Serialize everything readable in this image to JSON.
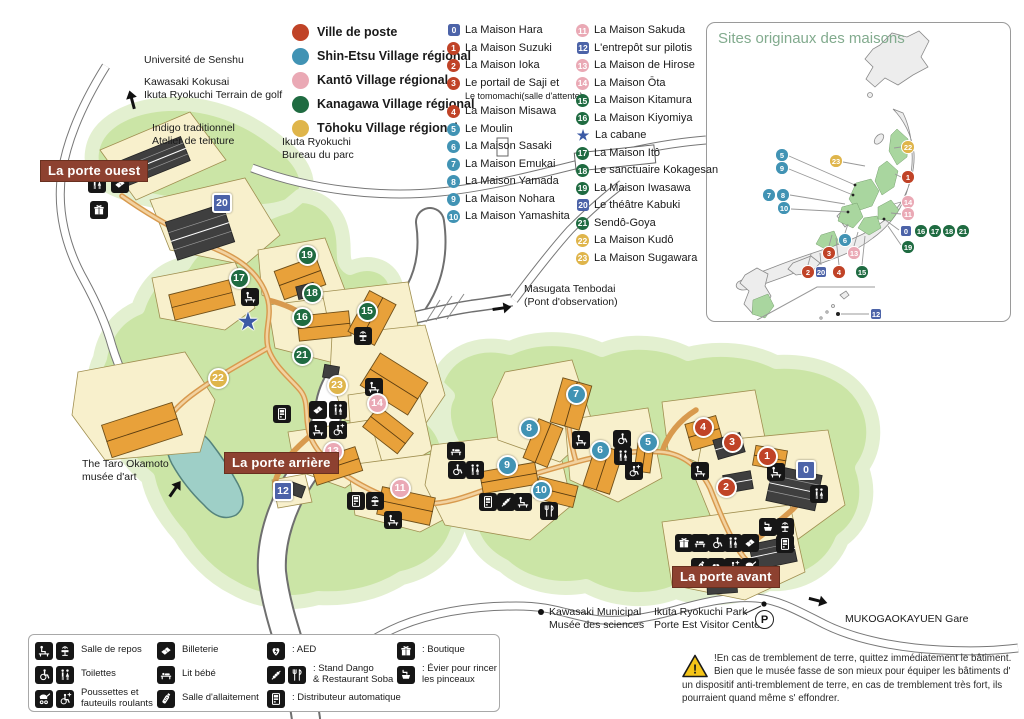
{
  "colors": {
    "red": "#c04327",
    "blue": "#4193b4",
    "pink": "#eaa9b5",
    "green": "#1f6b41",
    "yellow": "#dfb54b",
    "sqblue": "#4c63a8",
    "star": "#3b5aa5",
    "gate": "#8d4130",
    "title_green": "#82ab8e"
  },
  "villages": [
    {
      "label": "Ville de poste",
      "color": "red"
    },
    {
      "label": "Shin-Etsu Village régional",
      "color": "blue"
    },
    {
      "label": "Kantō Village régional",
      "color": "pink"
    },
    {
      "label": "Kanagawa Village régional",
      "color": "green"
    },
    {
      "label": "Tōhoku Village régional",
      "color": "yellow"
    }
  ],
  "houses": {
    "col1": [
      {
        "n": "0",
        "shape": "sq",
        "color": "sqblue",
        "label": "La Maison Hara"
      },
      {
        "n": "1",
        "shape": "c",
        "color": "red",
        "label": "La Maison Suzuki"
      },
      {
        "n": "2",
        "shape": "c",
        "color": "red",
        "label": "La Maison Ioka"
      },
      {
        "n": "3",
        "shape": "c",
        "color": "red",
        "label": "Le portail de Saji et",
        "sub": "Le tomomachi(salle d'attente)"
      },
      {
        "n": "4",
        "shape": "c",
        "color": "red",
        "label": "La Maison Misawa"
      },
      {
        "n": "5",
        "shape": "c",
        "color": "blue",
        "label": "Le Moulin"
      },
      {
        "n": "6",
        "shape": "c",
        "color": "blue",
        "label": "La Maison Sasaki"
      },
      {
        "n": "7",
        "shape": "c",
        "color": "blue",
        "label": "La Maison Emukai"
      },
      {
        "n": "8",
        "shape": "c",
        "color": "blue",
        "label": "La Maison Yamada"
      },
      {
        "n": "9",
        "shape": "c",
        "color": "blue",
        "label": "La Maison Nohara"
      },
      {
        "n": "10",
        "shape": "c",
        "color": "blue",
        "label": "La Maison Yamashita"
      }
    ],
    "col2": [
      {
        "n": "11",
        "shape": "c",
        "color": "pink",
        "label": "La Maison Sakuda"
      },
      {
        "n": "12",
        "shape": "sq",
        "color": "sqblue",
        "label": "L'entrepôt sur pilotis"
      },
      {
        "n": "13",
        "shape": "c",
        "color": "pink",
        "label": "La Maison de Hirose"
      },
      {
        "n": "14",
        "shape": "c",
        "color": "pink",
        "label": "La Maison Ōta"
      },
      {
        "n": "15",
        "shape": "c",
        "color": "green",
        "label": "La Maison Kitamura"
      },
      {
        "n": "16",
        "shape": "c",
        "color": "green",
        "label": "La Maison Kiyomiya"
      },
      {
        "n": "★",
        "shape": "st",
        "color": "star",
        "label": "La cabane"
      },
      {
        "n": "17",
        "shape": "c",
        "color": "green",
        "label": "La Maison Itô"
      },
      {
        "n": "18",
        "shape": "c",
        "color": "green",
        "label": "Le sanctuaire Kokagesan"
      },
      {
        "n": "19",
        "shape": "c",
        "color": "green",
        "label": "La Maison Iwasawa"
      },
      {
        "n": "20",
        "shape": "sq",
        "color": "sqblue",
        "label": "Le théâtre Kabuki"
      },
      {
        "n": "21",
        "shape": "c",
        "color": "green",
        "label": "Sendô-Goya"
      },
      {
        "n": "22",
        "shape": "c",
        "color": "yellow",
        "label": "La Maison Kudô"
      },
      {
        "n": "23",
        "shape": "c",
        "color": "yellow",
        "label": "La Maison Sugawara"
      }
    ]
  },
  "inset": {
    "title": "Sites originaux des maisons",
    "markers": [
      {
        "n": "5",
        "shape": "c",
        "color": "blue",
        "x": 75,
        "y": 132
      },
      {
        "n": "9",
        "shape": "c",
        "color": "blue",
        "x": 75,
        "y": 145
      },
      {
        "n": "7",
        "shape": "c",
        "color": "blue",
        "x": 62,
        "y": 172
      },
      {
        "n": "8",
        "shape": "c",
        "color": "blue",
        "x": 76,
        "y": 172
      },
      {
        "n": "10",
        "shape": "c",
        "color": "blue",
        "x": 77,
        "y": 185
      },
      {
        "n": "23",
        "shape": "c",
        "color": "yellow",
        "x": 129,
        "y": 138
      },
      {
        "n": "22",
        "shape": "c",
        "color": "yellow",
        "x": 201,
        "y": 124
      },
      {
        "n": "1",
        "shape": "c",
        "color": "red",
        "x": 201,
        "y": 154
      },
      {
        "n": "14",
        "shape": "c",
        "color": "pink",
        "x": 201,
        "y": 179
      },
      {
        "n": "11",
        "shape": "c",
        "color": "pink",
        "x": 201,
        "y": 191
      },
      {
        "n": "0",
        "shape": "sq",
        "color": "sqblue",
        "x": 199,
        "y": 208
      },
      {
        "n": "16",
        "shape": "c",
        "color": "green",
        "x": 214,
        "y": 208
      },
      {
        "n": "17",
        "shape": "c",
        "color": "green",
        "x": 228,
        "y": 208
      },
      {
        "n": "18",
        "shape": "c",
        "color": "green",
        "x": 242,
        "y": 208
      },
      {
        "n": "21",
        "shape": "c",
        "color": "green",
        "x": 256,
        "y": 208
      },
      {
        "n": "19",
        "shape": "c",
        "color": "green",
        "x": 201,
        "y": 224
      },
      {
        "n": "6",
        "shape": "c",
        "color": "blue",
        "x": 138,
        "y": 217
      },
      {
        "n": "3",
        "shape": "c",
        "color": "red",
        "x": 122,
        "y": 230
      },
      {
        "n": "13",
        "shape": "c",
        "color": "pink",
        "x": 147,
        "y": 230
      },
      {
        "n": "2",
        "shape": "c",
        "color": "red",
        "x": 101,
        "y": 249
      },
      {
        "n": "20",
        "shape": "sq",
        "color": "sqblue",
        "x": 114,
        "y": 249
      },
      {
        "n": "4",
        "shape": "c",
        "color": "red",
        "x": 132,
        "y": 249
      },
      {
        "n": "15",
        "shape": "c",
        "color": "green",
        "x": 155,
        "y": 249
      },
      {
        "n": "12",
        "shape": "sq",
        "color": "sqblue",
        "x": 169,
        "y": 291
      }
    ]
  },
  "map": {
    "parking_label": "P",
    "gates": [
      {
        "t": "La porte ouest",
        "x": 40,
        "y": 160
      },
      {
        "t": "La porte arrière",
        "x": 224,
        "y": 452
      },
      {
        "t": "La porte avant",
        "x": 672,
        "y": 566
      }
    ],
    "labels": [
      {
        "t": "Université de Senshu",
        "x": 144,
        "y": 54
      },
      {
        "t": "Kawasaki Kokusai\nIkuta Ryokuchi Terrain de golf",
        "x": 144,
        "y": 76
      },
      {
        "t": "Indigo traditionnel\nAtelier de teinture",
        "x": 152,
        "y": 122
      },
      {
        "t": "Ikuta Ryokuchi\nBureau du parc",
        "x": 282,
        "y": 136
      },
      {
        "t": "Masugata Tenbodai\n(Pont d'observation)",
        "x": 524,
        "y": 283
      },
      {
        "t": "The Taro Okamoto\nmusée d'art",
        "x": 82,
        "y": 458
      },
      {
        "t": "Kawasaki Municipal\nMusée des sciences",
        "x": 549,
        "y": 606
      },
      {
        "t": "Ikuta Ryokuchi Park\nPorte Est Visitor Center",
        "x": 654,
        "y": 606
      },
      {
        "t": "MUKOGAOKAYUEN Gare",
        "x": 845,
        "y": 613
      }
    ],
    "markers": [
      {
        "n": "0",
        "shape": "sq",
        "color": "sqblue",
        "x": 806,
        "y": 470
      },
      {
        "n": "1",
        "shape": "c",
        "color": "red",
        "x": 767,
        "y": 456
      },
      {
        "n": "2",
        "shape": "c",
        "color": "red",
        "x": 726,
        "y": 487
      },
      {
        "n": "3",
        "shape": "c",
        "color": "red",
        "x": 732,
        "y": 442
      },
      {
        "n": "4",
        "shape": "c",
        "color": "red",
        "x": 703,
        "y": 427
      },
      {
        "n": "5",
        "shape": "c",
        "color": "blue",
        "x": 648,
        "y": 442
      },
      {
        "n": "6",
        "shape": "c",
        "color": "blue",
        "x": 600,
        "y": 450
      },
      {
        "n": "7",
        "shape": "c",
        "color": "blue",
        "x": 576,
        "y": 394
      },
      {
        "n": "8",
        "shape": "c",
        "color": "blue",
        "x": 529,
        "y": 428
      },
      {
        "n": "9",
        "shape": "c",
        "color": "blue",
        "x": 507,
        "y": 465
      },
      {
        "n": "10",
        "shape": "c",
        "color": "blue",
        "x": 541,
        "y": 490
      },
      {
        "n": "11",
        "shape": "c",
        "color": "pink",
        "x": 400,
        "y": 488
      },
      {
        "n": "12",
        "shape": "sq",
        "color": "sqblue",
        "x": 283,
        "y": 491
      },
      {
        "n": "13",
        "shape": "c",
        "color": "pink",
        "x": 333,
        "y": 451
      },
      {
        "n": "14",
        "shape": "c",
        "color": "pink",
        "x": 377,
        "y": 403
      },
      {
        "n": "15",
        "shape": "c",
        "color": "green",
        "x": 367,
        "y": 311
      },
      {
        "n": "16",
        "shape": "c",
        "color": "green",
        "x": 302,
        "y": 317
      },
      {
        "n": "17",
        "shape": "c",
        "color": "green",
        "x": 239,
        "y": 278
      },
      {
        "n": "18",
        "shape": "c",
        "color": "green",
        "x": 312,
        "y": 293
      },
      {
        "n": "19",
        "shape": "c",
        "color": "green",
        "x": 307,
        "y": 255
      },
      {
        "n": "20",
        "shape": "sq",
        "color": "sqblue",
        "x": 222,
        "y": 203
      },
      {
        "n": "21",
        "shape": "c",
        "color": "green",
        "x": 302,
        "y": 355
      },
      {
        "n": "22",
        "shape": "c",
        "color": "yellow",
        "x": 218,
        "y": 378
      },
      {
        "n": "23",
        "shape": "c",
        "color": "yellow",
        "x": 337,
        "y": 385
      },
      {
        "n": "★",
        "shape": "st",
        "color": "star",
        "x": 248,
        "y": 322
      }
    ],
    "icons": [
      {
        "i": "toilets",
        "x": 97,
        "y": 184
      },
      {
        "i": "ticket",
        "x": 120,
        "y": 184
      },
      {
        "i": "boutique",
        "x": 99,
        "y": 210
      },
      {
        "i": "rest",
        "x": 250,
        "y": 297
      },
      {
        "i": "fountain",
        "x": 363,
        "y": 336
      },
      {
        "i": "rest",
        "x": 374,
        "y": 387
      },
      {
        "i": "vending",
        "x": 282,
        "y": 414
      },
      {
        "i": "ticket",
        "x": 318,
        "y": 410
      },
      {
        "i": "toilets",
        "x": 338,
        "y": 410
      },
      {
        "i": "rest",
        "x": 318,
        "y": 430
      },
      {
        "i": "wheelchair-star",
        "x": 338,
        "y": 430
      },
      {
        "i": "rest",
        "x": 320,
        "y": 461
      },
      {
        "i": "vending",
        "x": 356,
        "y": 501
      },
      {
        "i": "fountain",
        "x": 375,
        "y": 501
      },
      {
        "i": "rest",
        "x": 393,
        "y": 520
      },
      {
        "i": "baby",
        "x": 456,
        "y": 451
      },
      {
        "i": "wheelchair",
        "x": 457,
        "y": 470
      },
      {
        "i": "toilets",
        "x": 475,
        "y": 470
      },
      {
        "i": "vending",
        "x": 488,
        "y": 502
      },
      {
        "i": "dango",
        "x": 506,
        "y": 502
      },
      {
        "i": "rest",
        "x": 523,
        "y": 502
      },
      {
        "i": "restaurant",
        "x": 549,
        "y": 511
      },
      {
        "i": "rest",
        "x": 581,
        "y": 440
      },
      {
        "i": "wheelchair",
        "x": 622,
        "y": 439
      },
      {
        "i": "toilets",
        "x": 623,
        "y": 456
      },
      {
        "i": "wheelchair-star",
        "x": 634,
        "y": 471
      },
      {
        "i": "rest",
        "x": 700,
        "y": 471
      },
      {
        "i": "rest",
        "x": 776,
        "y": 472
      },
      {
        "i": "toilets",
        "x": 819,
        "y": 494
      },
      {
        "i": "boutique",
        "x": 684,
        "y": 543
      },
      {
        "i": "baby",
        "x": 700,
        "y": 543
      },
      {
        "i": "wheelchair",
        "x": 717,
        "y": 543
      },
      {
        "i": "toilets",
        "x": 733,
        "y": 543
      },
      {
        "i": "ticket",
        "x": 750,
        "y": 543
      },
      {
        "i": "bottle",
        "x": 700,
        "y": 567
      },
      {
        "i": "aed",
        "x": 716,
        "y": 567
      },
      {
        "i": "wheelchair-star",
        "x": 733,
        "y": 567
      },
      {
        "i": "stroller",
        "x": 750,
        "y": 567
      },
      {
        "i": "sink",
        "x": 768,
        "y": 527
      },
      {
        "i": "fountain",
        "x": 785,
        "y": 527
      },
      {
        "i": "vending",
        "x": 785,
        "y": 544
      }
    ]
  },
  "facilities": {
    "columns": [
      [
        {
          "icons": [
            "rest",
            "fountain"
          ],
          "label": "Salle de repos"
        },
        {
          "icons": [
            "wheelchair",
            "toilets"
          ],
          "label": "Toilettes"
        },
        {
          "icons": [
            "stroller",
            "wheelchair-star"
          ],
          "label": "Poussettes et\nfauteuils roulants"
        }
      ],
      [
        {
          "icons": [
            "ticket"
          ],
          "label": "Billeterie"
        },
        {
          "icons": [
            "baby"
          ],
          "label": "Lit bébé"
        },
        {
          "icons": [
            "bottle"
          ],
          "label": "Salle d'allaitement"
        }
      ],
      [
        {
          "icons": [
            "aed"
          ],
          "label": ": AED"
        },
        {
          "icons": [
            "dango",
            "restaurant"
          ],
          "label": ": Stand Dango\n  & Restaurant Soba"
        },
        {
          "icons": [
            "vending"
          ],
          "label": ": Distributeur automatique"
        }
      ],
      [
        {
          "icons": [
            "boutique"
          ],
          "label": ": Boutique"
        },
        {
          "icons": [
            "sink"
          ],
          "label": ": Évier pour rincer\nles pinceaux"
        }
      ]
    ]
  },
  "warning": {
    "text": "!En cas de tremblement de terre, quittez immédiatement le bâtiment. Bien que le musée fasse de son mieux pour équiper les bâtiments d' un dispositif anti-tremblement de terre, en cas de tremblement très fort, ils pourraient quand même s' effondrer."
  }
}
